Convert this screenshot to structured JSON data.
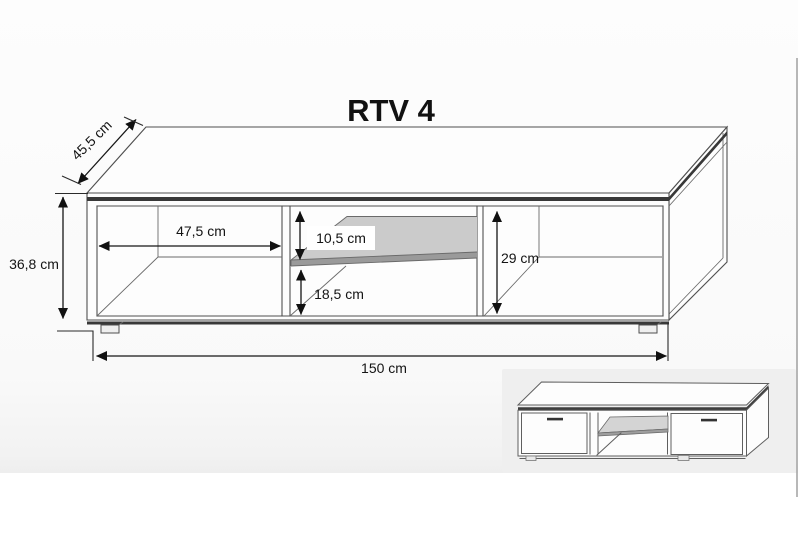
{
  "page": {
    "background": "#ffffff",
    "sheet_tint": "#efefef",
    "right_border_color": "#ababab"
  },
  "drawing": {
    "title": "RTV 4",
    "unit": "cm",
    "labels": {
      "depth": "45,5 cm",
      "total_height": "36,8 cm",
      "left_compartment_width": "47,5 cm",
      "middle_upper_opening": "10,5 cm",
      "middle_lower_opening": "18,5 cm",
      "side_compartment_height": "29 cm",
      "total_width": "150 cm"
    },
    "colors": {
      "line": "#4f4f4f",
      "dimension": "#161616",
      "edge_band": "#383838",
      "shelf_top": "#cbcbcb",
      "shelf_edge": "#9a9a9a"
    }
  },
  "thumbnail": {
    "colors": {
      "background": "#efefef",
      "shelf_top": "#d4d4d4",
      "shelf_edge": "#9e9e9e",
      "handle": "#333333"
    }
  }
}
